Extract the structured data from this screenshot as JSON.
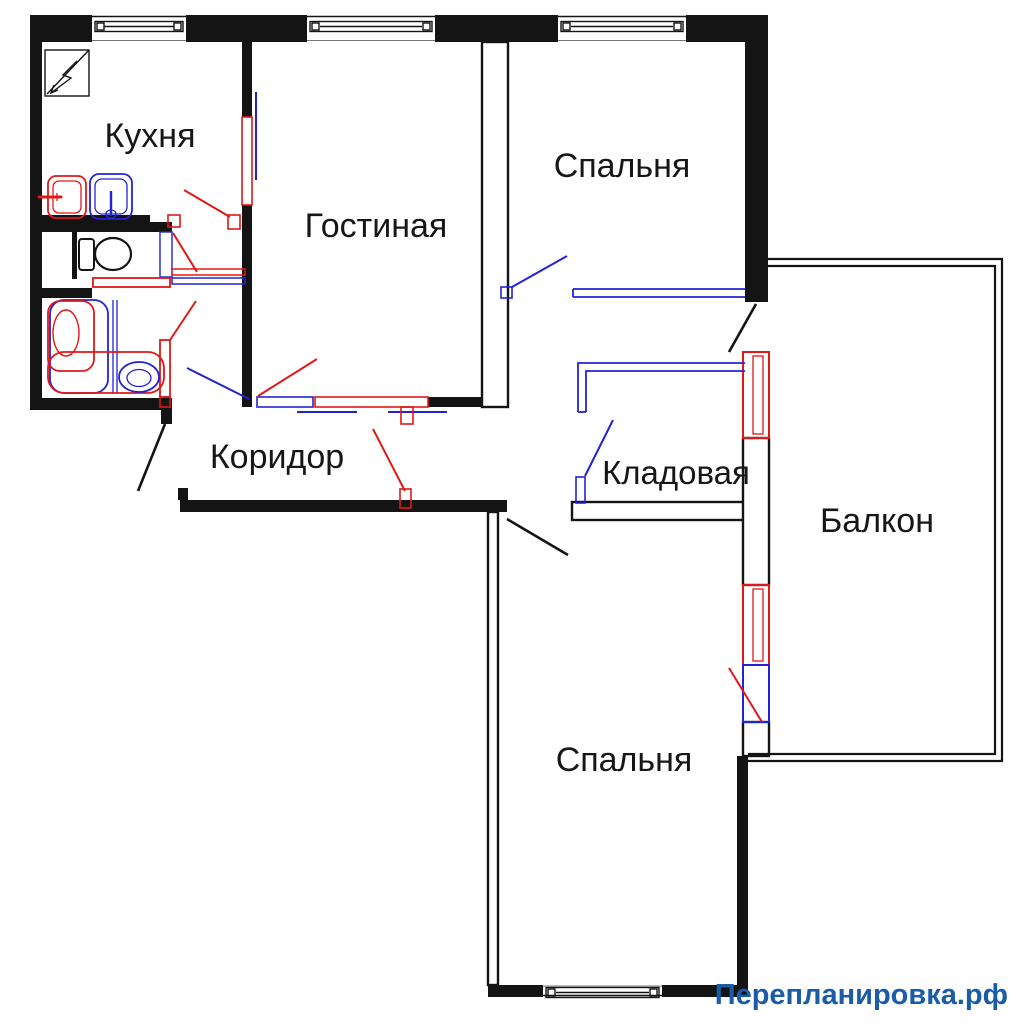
{
  "colors": {
    "wall": "#141414",
    "red": "#e01818",
    "blue": "#2323d6",
    "watermark": "#1a5ca8",
    "window_inner": "#777777",
    "bg": "#ffffff"
  },
  "rooms": {
    "kitchen": {
      "label": "Кухня"
    },
    "living": {
      "label": "Гостиная"
    },
    "bedroom_top": {
      "label": "Спальня"
    },
    "bedroom_bottom": {
      "label": "Спальня"
    },
    "balcony": {
      "label": "Балкон"
    },
    "storage": {
      "label": "Кладовая"
    },
    "corridor": {
      "label": "Коридор"
    }
  },
  "watermark": {
    "text": "Перепланировка.рф"
  },
  "icons": {
    "stove-icon": "square with lightning arrow (kitchen stove/electric panel)",
    "sink-red-icon": "red kitchen sink (old position)",
    "sink-blue-icon": "blue kitchen sink (new position)",
    "toilet-icon": "toilet with tank",
    "bathtub-red-icon": "red bathtub (old position)",
    "bathtub-blue-icon": "blue bathtub (new position)",
    "washbasin-blue-icon": "blue wash basin oval"
  },
  "legend": {
    "red_meaning": "demolished / old elements",
    "blue_meaning": "new / constructed elements",
    "black_meaning": "existing walls"
  }
}
